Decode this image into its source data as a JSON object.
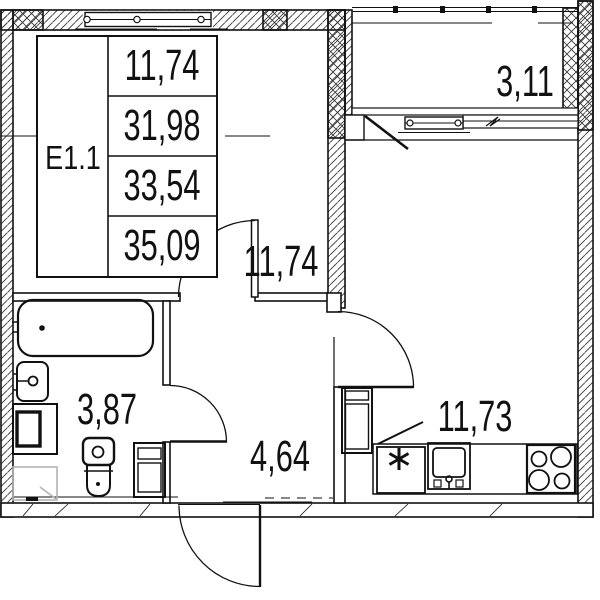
{
  "plan": {
    "type_code": "Е1.1",
    "area_table": {
      "values": [
        "11,74",
        "31,98",
        "33,54",
        "35,09"
      ]
    },
    "rooms": {
      "main_room": {
        "name": "room",
        "area": "11,74"
      },
      "balcony": {
        "name": "balcony",
        "area": "3,11"
      },
      "kitchen_living": {
        "name": "kitchen-living",
        "area": "11,73"
      },
      "hallway": {
        "name": "hallway",
        "area": "4,64"
      },
      "bathroom": {
        "name": "bathroom",
        "area": "3,87"
      }
    },
    "colors": {
      "line": "#111111",
      "hatch": "#333333",
      "tray_gray": "#b3b3b3",
      "background": "#ffffff"
    }
  }
}
